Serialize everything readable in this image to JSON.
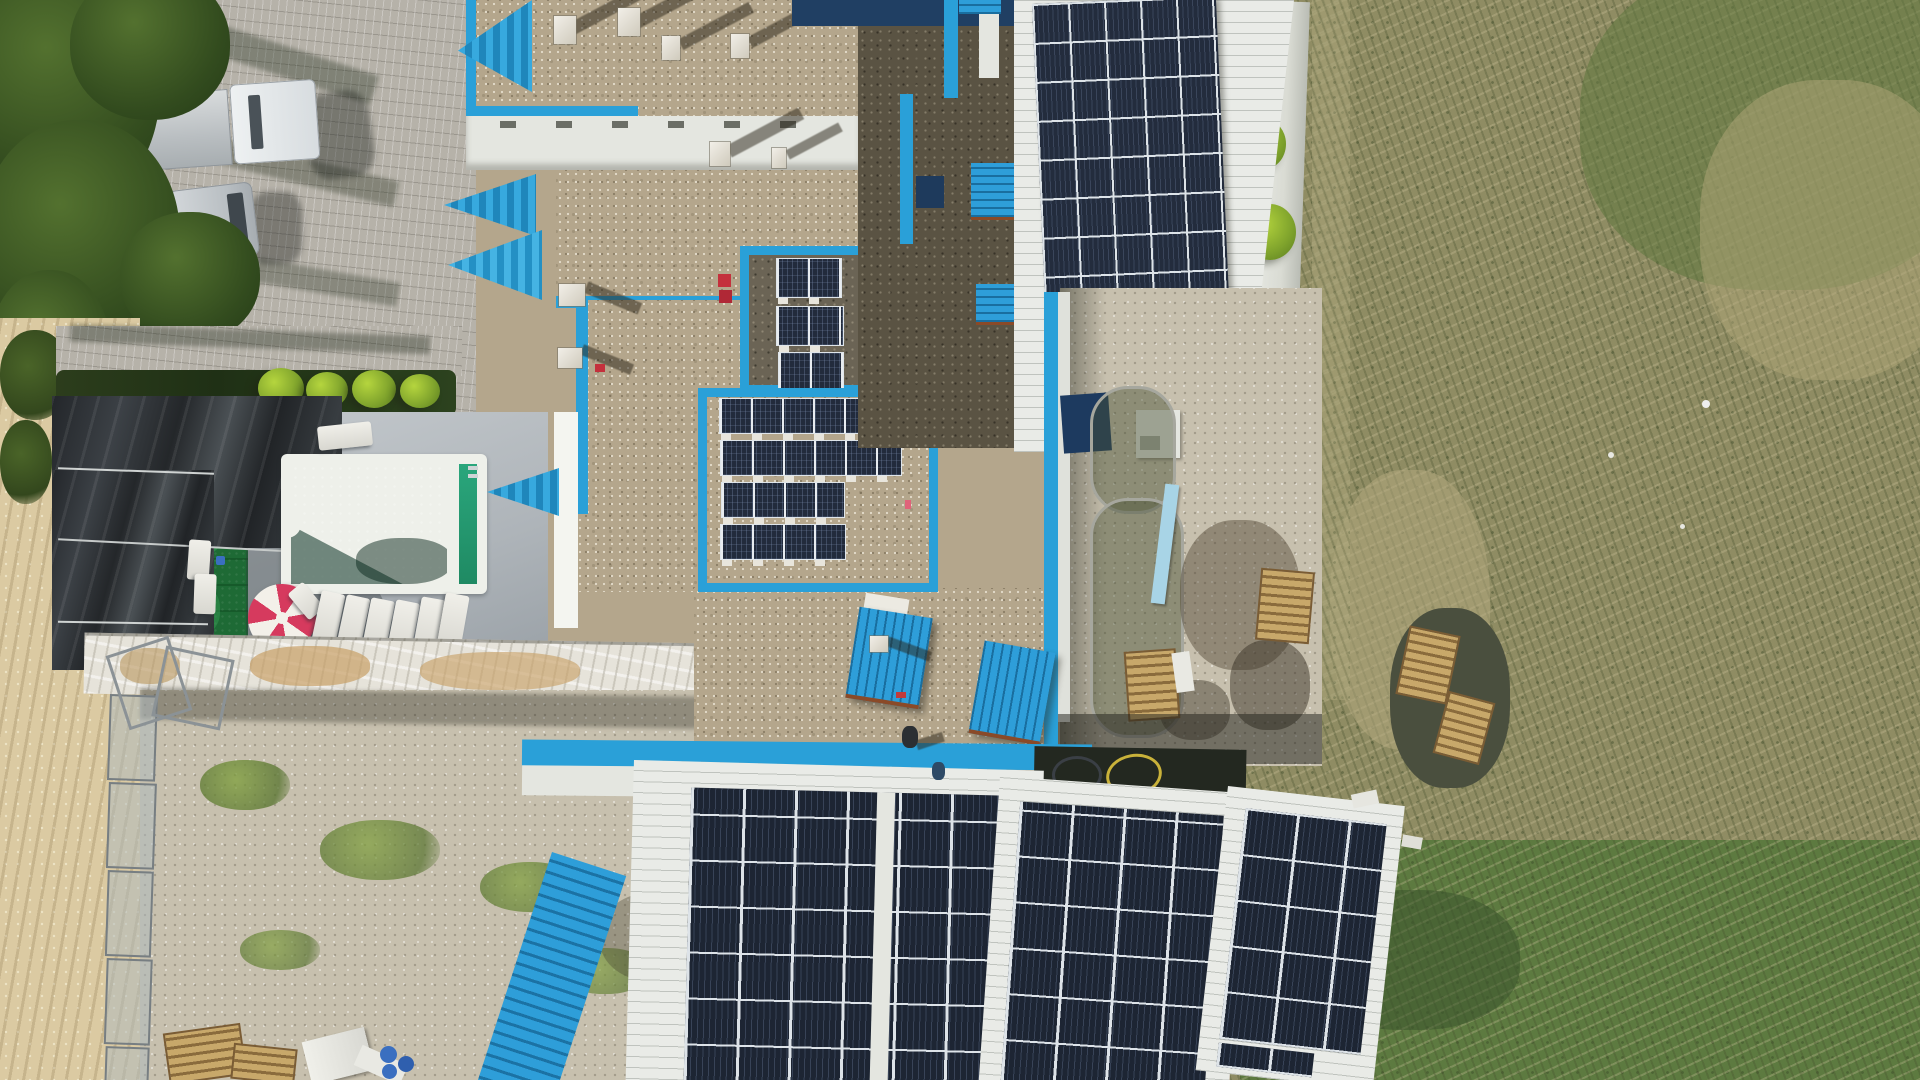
{
  "scene": {
    "type": "aerial-drone-photograph",
    "description": "Top-down drone view of a blue-and-white hotel/leisure building with gravel flat roofs, rooftop solar panel arrays, a turquoise swimming pool with sun loungers and a red-and-white parasol, a black-tarp covered green court, parked truck and van beside trees, paver yards, a white perimeter wall with bright green bushes, and a large dry grass field on the right."
  },
  "colors": {
    "parapet_blue": "#2aa0d8",
    "skylight_blue": "#2e9ed9",
    "panel_navy": "#1d2533",
    "panel_grid": "#dde3e8",
    "metal_roof_white": "#e9ebe7",
    "gravel_light": "#b4a68c",
    "gravel_dark": "#5a5343",
    "pool_water": "#3ecfa9",
    "pool_deep": "#1b7a56",
    "turf_green": "#1e6a35",
    "umbrella_red": "#d63a5e",
    "umbrella_white": "#f3f0e9",
    "grass_field": "#8f8c63",
    "bush_green": "#9dc032",
    "wall_white": "#e4e6e0",
    "paver_light": "#c7c0ae",
    "brick_gray": "#b6b2a9",
    "sand_tan": "#dbcaa2",
    "hose_yellow": "#c9b23a",
    "rust_edge": "#8a4a28",
    "red_accent": "#c4303c",
    "barrel_blue": "#3a6fc0"
  },
  "objects": {
    "vehicles": {
      "truck": "white cab with light-gray box trailer",
      "van": "silver van"
    },
    "pool": {
      "water": "turquoise-green",
      "features": [
        "white rim",
        "steps notch",
        "white divider",
        "ladder"
      ]
    },
    "parasol": {
      "segments": 8,
      "pattern": "alternating red and white"
    },
    "sun_loungers": {
      "deck_row": 7,
      "poolside_top": 1,
      "turf_pair": 2
    },
    "solar_arrays": {
      "top_right_roof": {
        "columns": 5,
        "rows": 10
      },
      "bottom_roofs": 3,
      "ballasted_rows_on_gravel": [
        2,
        2,
        2,
        6,
        6,
        4,
        4
      ]
    },
    "blue_elements": [
      "pitched entrance awnings x3",
      "corrugated skylights x3",
      "corrugated canopies x2",
      "parapet trim"
    ],
    "chimneys_vents": 10,
    "pallets": 6,
    "blue_barrels": 3,
    "people_on_roof": 2,
    "perimeter_wall_bushes": 4,
    "black_tarp": "draped over frame beside green court",
    "hoses": [
      "yellow coiled hose",
      "dark coiled hose"
    ]
  }
}
